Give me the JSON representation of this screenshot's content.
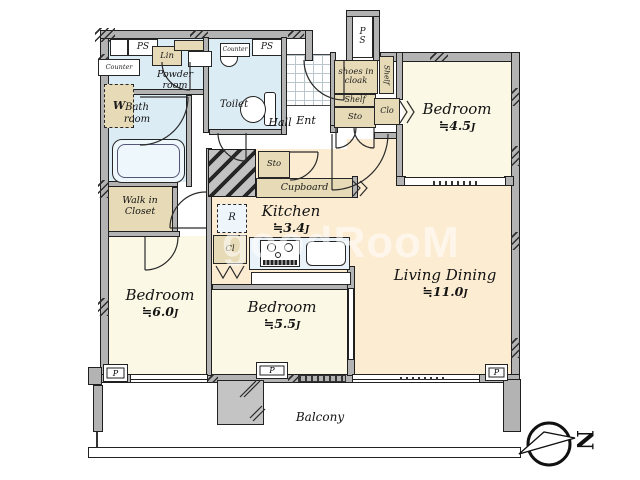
{
  "watermark": "goodRooM",
  "compass": {
    "north": "N"
  },
  "rooms": {
    "bedroom1": {
      "name": "Bedroom",
      "area": "≒4.5",
      "unit": "J"
    },
    "bedroom2": {
      "name": "Bedroom",
      "area": "≒6.0",
      "unit": "J"
    },
    "bedroom3": {
      "name": "Bedroom",
      "area": "≒5.5",
      "unit": "J"
    },
    "living": {
      "name": "Living Dining",
      "area": "≒11.0",
      "unit": "J"
    },
    "kitchen": {
      "name": "Kitchen",
      "area": "≒3.4",
      "unit": "J"
    },
    "hall": "Hall",
    "ent": "Ent",
    "toilet": "Toilet",
    "bath": "Bath\nroom",
    "powder": "Powder\nroom",
    "wic": "Walk in\nCloset",
    "shoes": "shoes in\ncloak",
    "balcony": "Balcony"
  },
  "fixtures": {
    "ps": "PS",
    "ps_vertical": "P\nS",
    "counter": "Counter",
    "lin": "Lin",
    "w": "W",
    "shelf": "Shelf",
    "sto": "Sto",
    "clo": "Clo",
    "cl": "Cl",
    "cupboard": "Cupboard",
    "r": "R",
    "p": "P"
  }
}
